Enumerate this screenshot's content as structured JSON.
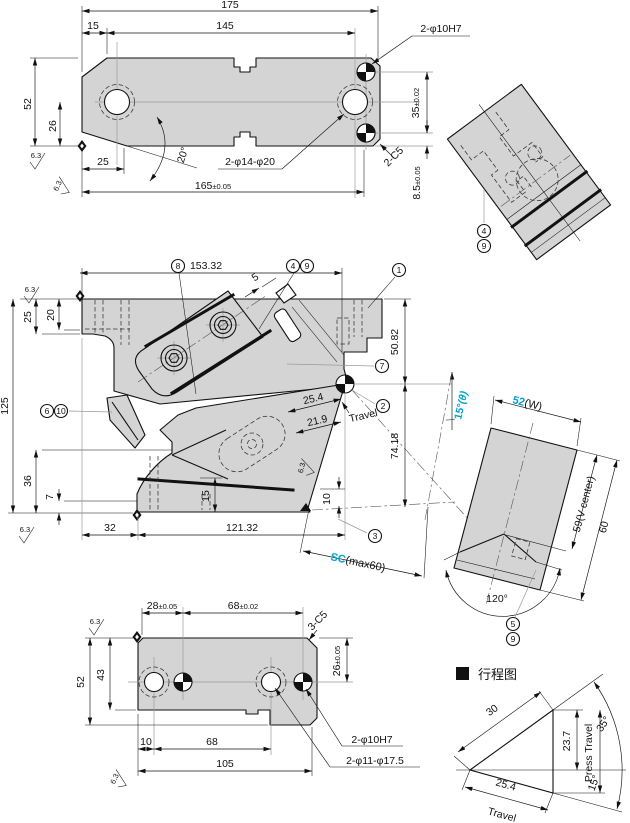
{
  "colors": {
    "part_fill": "#d4d4d4",
    "line": "#111111",
    "accent": "#00a2cc",
    "muted": "#9a9a9a"
  },
  "front": {
    "d175": "175",
    "d15": "15",
    "d145": "145",
    "d52": "52",
    "d26": "26",
    "d25": "25",
    "a20": "20°",
    "d165": "165",
    "d165tol": "±0.05",
    "label_holes": "2-φ14-φ20",
    "label_dowels": "2-φ10H7",
    "d35": "35",
    "d35tol": "±0.02",
    "c5": "2-C5",
    "d85": "8.5",
    "d85tol": "±0.05",
    "sf": "6.3"
  },
  "iso": {
    "b4": "4",
    "b9": "9"
  },
  "main": {
    "d15332": "153.32",
    "d5": "5",
    "b1": "1",
    "b2": "2",
    "b3": "3",
    "b4": "4",
    "b6": "6",
    "b7": "7",
    "b8": "8",
    "b9": "9",
    "b10": "10",
    "d5082": "50.82",
    "d7418": "74.18",
    "d254": "25.4",
    "travel": "Travel",
    "d219": "21.9",
    "d125": "125",
    "d25": "25",
    "d20": "20",
    "d36": "36",
    "d7": "7",
    "d32": "32",
    "d12132": "121.32",
    "d15": "15",
    "d10": "10",
    "sc": "SC",
    "scmax": "(max60)",
    "a15": "15°",
    "a15sub": "(θ)",
    "sf": "6.3"
  },
  "vblock": {
    "w": "52",
    "wlbl": "(W)",
    "vcenter": "59(V center)",
    "d60": "60",
    "a120": "120°",
    "b5": "5",
    "b9": "9"
  },
  "bottom": {
    "d28": "28",
    "d28tol": "±0.05",
    "d68u": "68",
    "d68tol": "±0.02",
    "c5": "3-C5",
    "d26": "26",
    "d26tol": "±0.05",
    "d52": "52",
    "d43": "43",
    "d10": "10",
    "d68": "68",
    "d105": "105",
    "label_dowels": "2-φ10H7",
    "label_holes": "2-φ11-φ17.5",
    "sf": "6.3"
  },
  "travel": {
    "header": "行程图",
    "d30": "30",
    "d237": "23.7",
    "d254": "25.4",
    "press": "Press Travel",
    "travel": "Travel",
    "a35": "35°",
    "a15": "15°"
  }
}
